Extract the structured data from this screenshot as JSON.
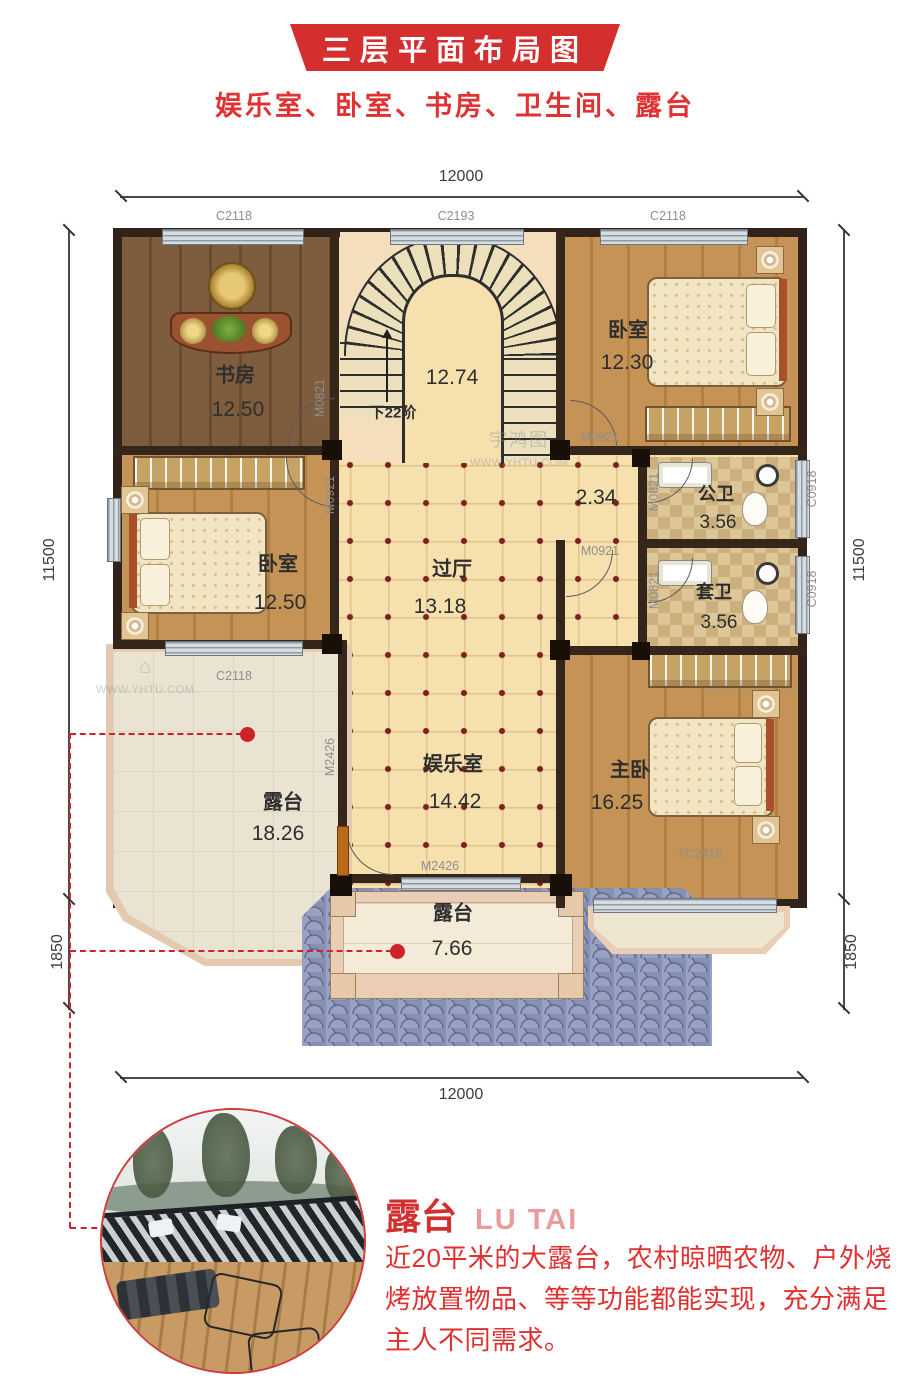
{
  "banner": {
    "title": "三层平面布局图"
  },
  "subtitle": "娱乐室、卧室、书房、卫生间、露台",
  "dims": {
    "width": "12000",
    "height": "11500",
    "ext": "1850"
  },
  "openings": {
    "c2118": "C2118",
    "c2193": "C2193",
    "c0918": "C0918",
    "m0821": "M0821",
    "m0921": "M0921",
    "m2426": "M2426",
    "tc2418": "TC2418"
  },
  "rooms": {
    "study": {
      "name": "书房",
      "area": "12.50"
    },
    "stairs": {
      "area": "12.74",
      "note": "下22阶"
    },
    "bedroom_top_right": {
      "name": "卧室",
      "area": "12.30"
    },
    "bedroom_left": {
      "name": "卧室",
      "area": "12.50"
    },
    "hall": {
      "name": "过厅",
      "area": "13.18"
    },
    "corridor": {
      "area": "2.34"
    },
    "bath_public": {
      "name": "公卫",
      "area": "3.56"
    },
    "bath_ensuite": {
      "name": "套卫",
      "area": "3.56"
    },
    "entertainment": {
      "name": "娱乐室",
      "area": "14.42"
    },
    "master": {
      "name": "主卧",
      "area": "16.25"
    },
    "terrace_large": {
      "name": "露台",
      "area": "18.26"
    },
    "terrace_small": {
      "name": "露台",
      "area": "7.66"
    }
  },
  "callout": {
    "title": "露台",
    "title_en": "LU TAI",
    "description": "近20平米的大露台，农村晾晒农物、户外烧烤放置物品、等等功能都能实现，充分满足主人不同需求。"
  },
  "watermark": {
    "brand": "宇鸿图",
    "url": "WWW.YHTU.COM"
  },
  "colors": {
    "accent": "#d32f2f",
    "wall": "#35261b",
    "roof": "#868fb4"
  }
}
